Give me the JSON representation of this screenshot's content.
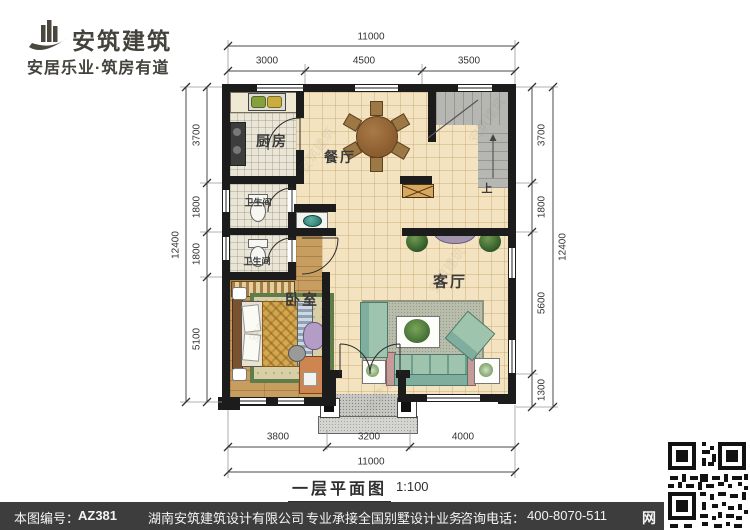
{
  "brand": {
    "name": "安筑建筑",
    "tagline": "安居乐业·筑房有道"
  },
  "plan": {
    "rooms": {
      "kitchen": "厨房",
      "dining": "餐厅",
      "bathroom": "卫生间",
      "bedroom": "卧室",
      "living": "客厅",
      "stairs_up": "上"
    },
    "dims": {
      "top": {
        "total": "11000",
        "segments": [
          "3000",
          "4500",
          "3500"
        ]
      },
      "bottom": {
        "total": "11000",
        "segments": [
          "3800",
          "3200",
          "4000"
        ]
      },
      "left": {
        "total": "12400",
        "segments": [
          "3700",
          "1800",
          "1800",
          "5100"
        ]
      },
      "right": {
        "total": "12400",
        "segments": [
          "3700",
          "1800",
          "5600",
          "1300"
        ]
      }
    },
    "caption": {
      "title": "一层平面图",
      "scale": "1:100"
    }
  },
  "footer": {
    "serial_label": "本图编号：",
    "serial": "AZ381",
    "company": "湖南安筑建筑设计有限公司",
    "slogan": "专业承接全国别墅设计业务",
    "phone_label": "咨询电话：",
    "phone": "400-8070-511",
    "site_badge": "网"
  },
  "watermark": {
    "text": "安筑建筑"
  },
  "colors": {
    "wall": "#1c1c1c",
    "tile_floor": "#f3e3c1",
    "mosaic_floor": "#e9e5d7",
    "wood_floor": "#c79d60",
    "stair_gray": "#b6b6b3",
    "accent_teal": "#2e8076",
    "footer_bg": "#3d3d3d"
  }
}
